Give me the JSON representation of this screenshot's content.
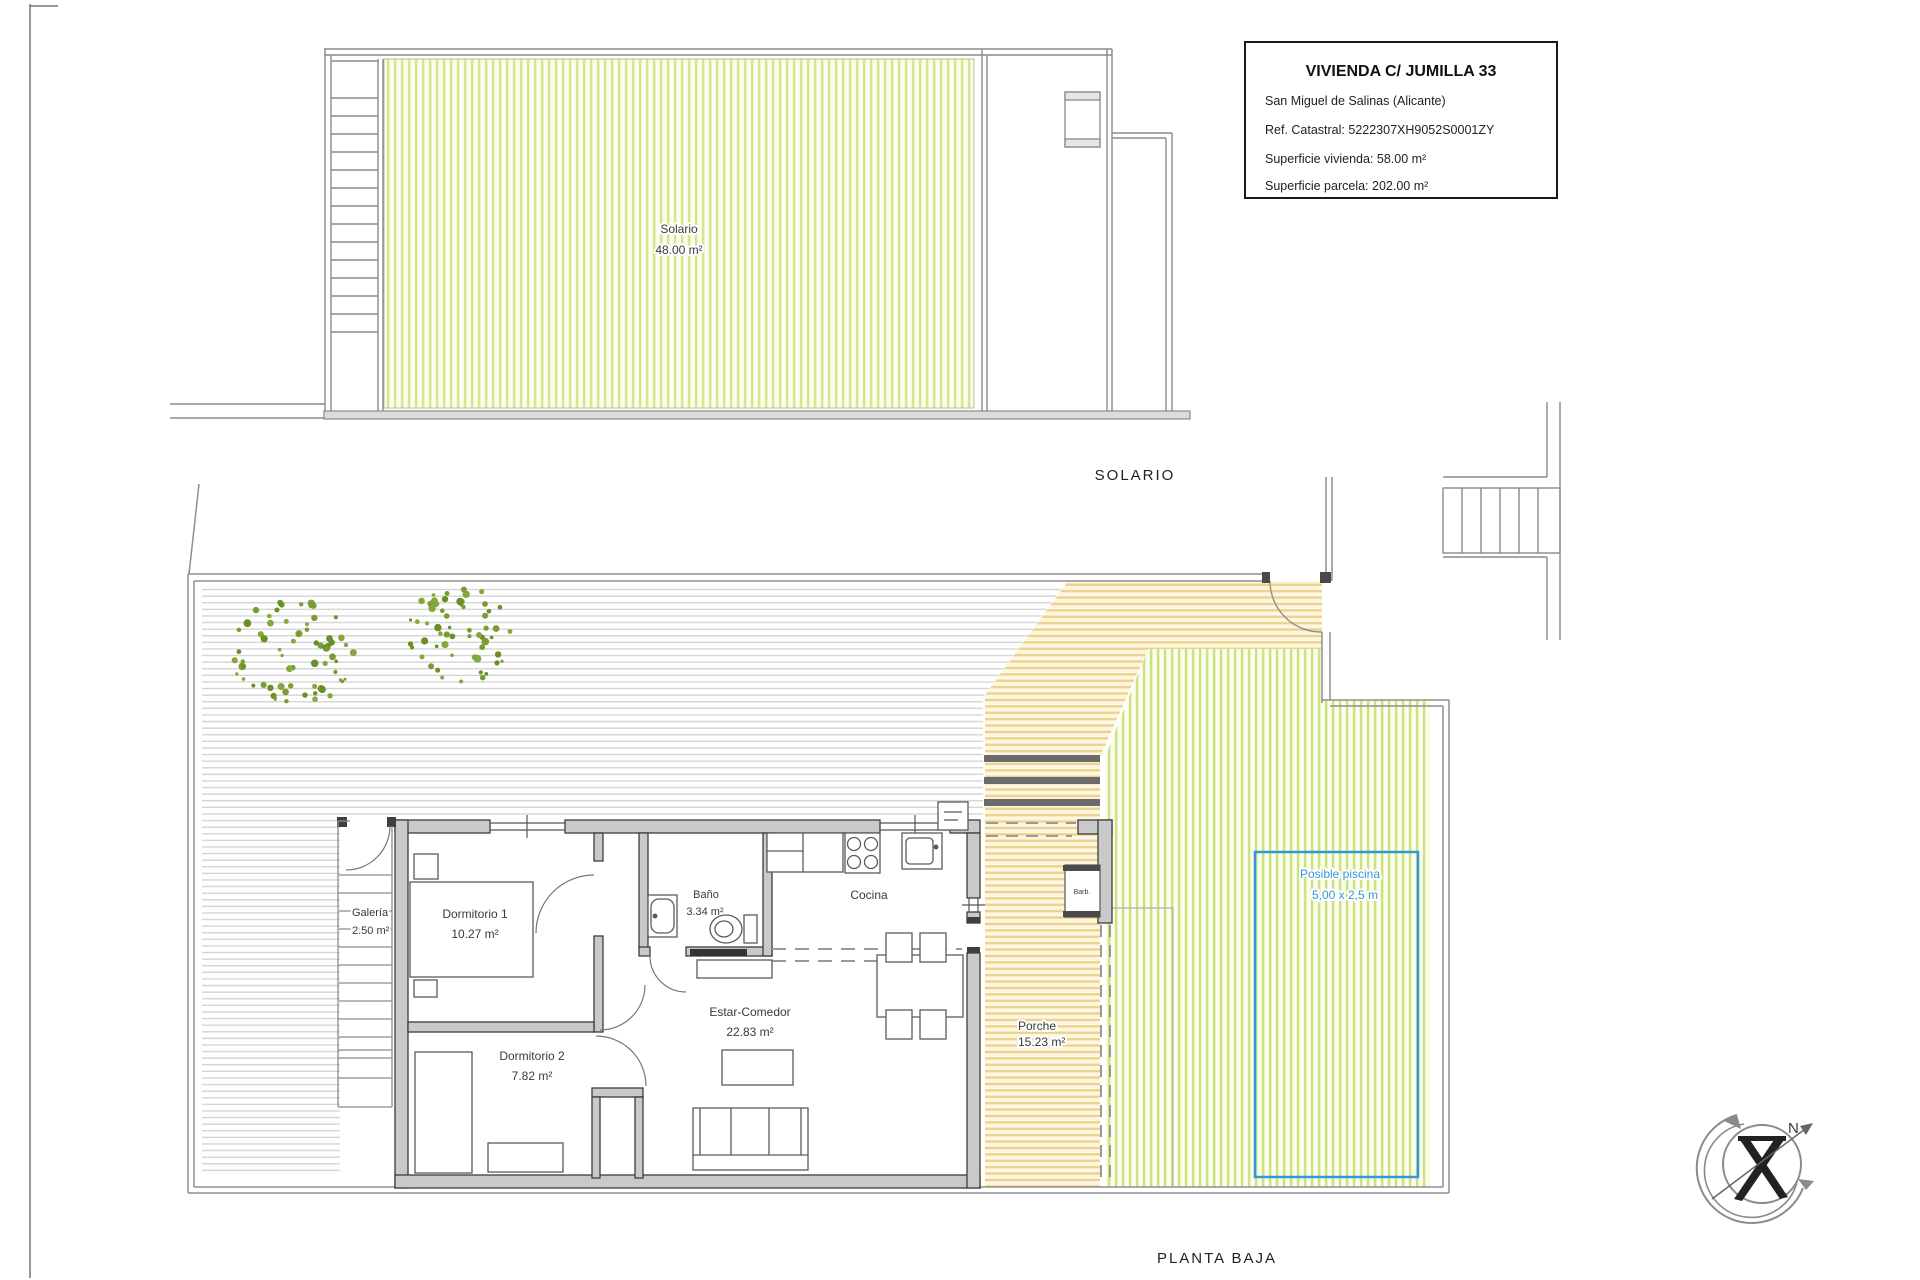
{
  "title_block": {
    "title": "VIVIENDA C/ JUMILLA 33",
    "location": "San Miguel de Salinas (Alicante)",
    "ref_catastral": "Ref. Catastral: 5222307XH9052S0001ZY",
    "superficie_vivienda": "Superficie vivienda: 58.00 m²",
    "superficie_parcela": "Superficie parcela: 202.00 m²"
  },
  "solario_plan": {
    "section_label": "SOLARIO",
    "room": {
      "name": "Solario",
      "area": "48.00 m²"
    }
  },
  "planta_baja_plan": {
    "section_label": "PLANTA BAJA",
    "rooms": {
      "dormitorio1": {
        "name": "Dormitorio 1",
        "area": "10.27 m²"
      },
      "dormitorio2": {
        "name": "Dormitorio 2",
        "area": "7.82 m²"
      },
      "bano": {
        "name": "Baño",
        "area": "3.34 m²"
      },
      "cocina": {
        "name": "Cocina"
      },
      "estar_comedor": {
        "name": "Estar-Comedor",
        "area": "22.83 m²"
      },
      "galeria": {
        "name": "Galería",
        "area": "2.50 m²"
      },
      "porche": {
        "name": "Porche",
        "area": "15.23 m²"
      }
    },
    "pool": {
      "line1": "Posible piscina",
      "line2": "5,00 x 2,5 m",
      "color": "#3598d4"
    },
    "barbecue_label": "Barb."
  },
  "compass": {
    "north_label": "N"
  },
  "colors": {
    "solarium_hatch": "#d6e58e",
    "lawn_hatch": "#cde283",
    "porch_hatch": "#ecd18c",
    "paving_hatch": "#d2d2d2",
    "wall_fill": "#c9c9c9",
    "pool_blue": "#3598d4",
    "tree_green": "#6b8c26"
  }
}
